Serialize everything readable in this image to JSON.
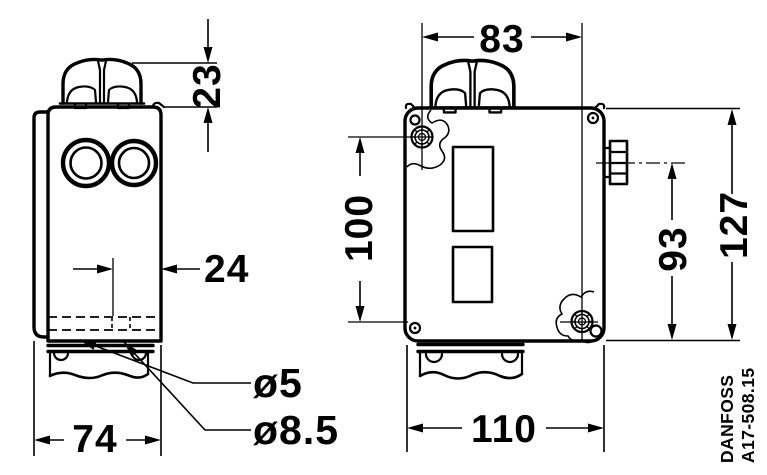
{
  "drawing": {
    "views": {
      "side": {
        "dim_knob_height": "23",
        "dim_hole_offset": "24",
        "dim_width": "74",
        "hole_diameter_small": "ø5",
        "hole_diameter_large": "ø8.5"
      },
      "front": {
        "dim_hole_spacing_horizontal": "83",
        "dim_hole_spacing_vertical": "100",
        "dim_connector_height": "93",
        "dim_total_height": "127",
        "dim_bottom_width": "110"
      }
    },
    "footer": {
      "brand": "DANFOSS",
      "drawing_number": "A17-508.15"
    },
    "colors": {
      "line": "#000000",
      "background": "#ffffff"
    }
  }
}
